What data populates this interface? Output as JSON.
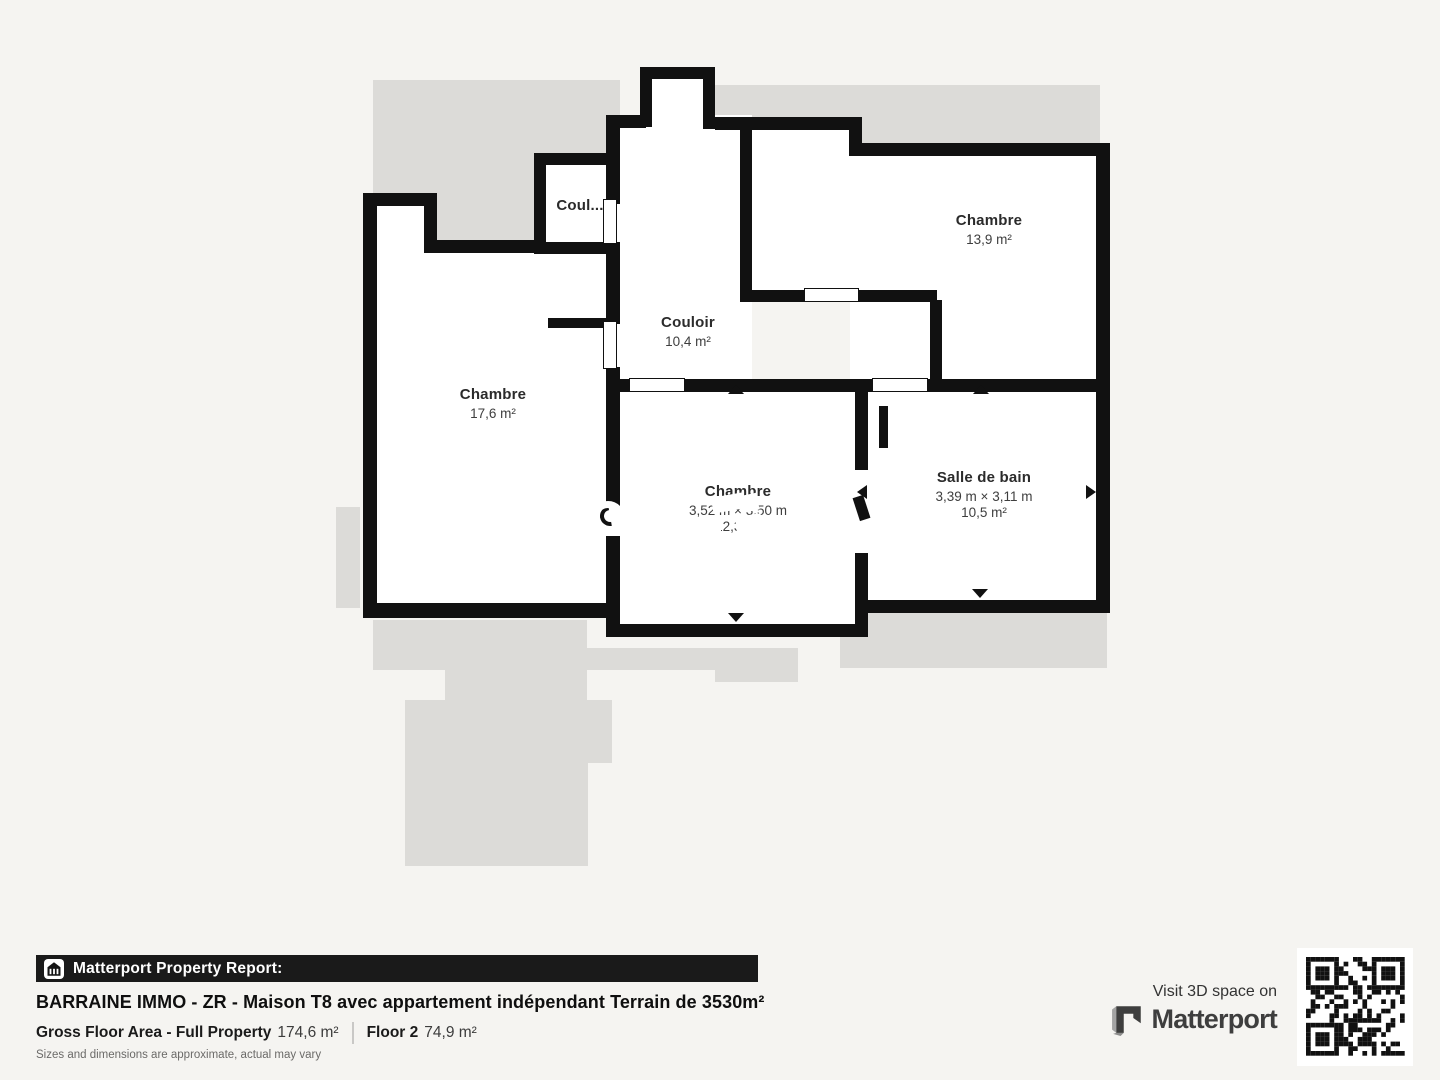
{
  "plan": {
    "rooms": [
      {
        "id": "chambre-left",
        "name": "Chambre",
        "area": "17,6 m²"
      },
      {
        "id": "couloir-small",
        "name": "Coul..."
      },
      {
        "id": "couloir",
        "name": "Couloir",
        "area": "10,4 m²"
      },
      {
        "id": "chambre-right",
        "name": "Chambre",
        "area": "13,9 m²"
      },
      {
        "id": "chambre-middle",
        "name": "Chambre",
        "dimensions": "3,52 m × 3,50 m",
        "area": "12,3 m²"
      },
      {
        "id": "salle-de-bain",
        "name": "Salle de bain",
        "dimensions": "3,39 m × 3,11 m",
        "area": "10,5 m²"
      }
    ]
  },
  "footer": {
    "report_label": "Matterport Property Report:",
    "title": "BARRAINE IMMO - ZR - Maison T8 avec appartement indépendant Terrain de 3530m²",
    "gross_floor_label": "Gross Floor Area - Full Property",
    "gross_floor_value": "174,6 m²",
    "floor_label": "Floor 2",
    "floor_value": "74,9 m²",
    "disclaimer": "Sizes and dimensions are approximate, actual may vary",
    "visit_label": "Visit 3D space on",
    "brand": "Matterport"
  },
  "colors": {
    "page_background": "#f5f4f1",
    "floor_silhouette": "#dcdbd8",
    "walls": "#111111",
    "footer_bar": "#1a1a1a"
  }
}
